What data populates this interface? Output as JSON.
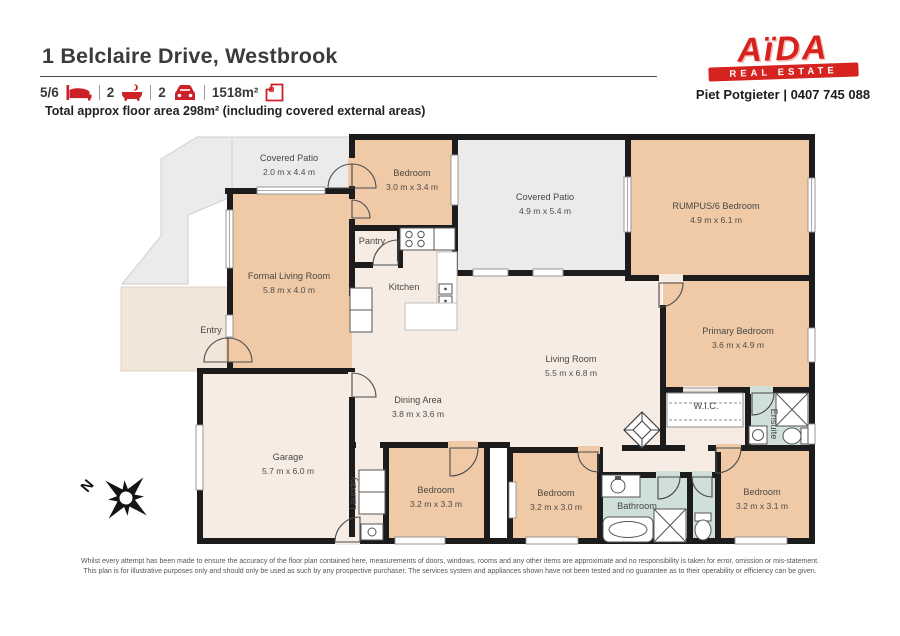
{
  "header": {
    "title": "1 Belclaire Drive, Westbrook",
    "stats": [
      {
        "value": "5/6",
        "icon": "bed-icon"
      },
      {
        "value": "2",
        "icon": "bath-icon"
      },
      {
        "value": "2",
        "icon": "car-icon"
      },
      {
        "value": "1518m²",
        "icon": "land-area-icon"
      }
    ],
    "floor_area_note": "Total approx floor area 298m² (including covered external areas)"
  },
  "agency": {
    "logo_word": "AïDA",
    "logo_banner": "REAL ESTATE",
    "contact": "Piet Potgieter | 0407 745 088"
  },
  "floorplan": {
    "compass_label": "N",
    "rooms": [
      {
        "name": "Covered Patio",
        "dims": "2.0 m x 4.4 m"
      },
      {
        "name": "Bedroom",
        "dims": "3.0 m x 3.4 m"
      },
      {
        "name": "Covered Patio",
        "dims": "4.9 m x 5.4 m"
      },
      {
        "name": "RUMPUS/6 Bedroom",
        "dims": "4.9 m x 6.1 m"
      },
      {
        "name": "Formal Living Room",
        "dims": "5.8 m x 4.0 m"
      },
      {
        "name": "Pantry",
        "dims": ""
      },
      {
        "name": "Kitchen",
        "dims": ""
      },
      {
        "name": "Entry",
        "dims": ""
      },
      {
        "name": "Living Room",
        "dims": "5.5 m x 6.8 m"
      },
      {
        "name": "Dining Area",
        "dims": "3.8 m x 3.6 m"
      },
      {
        "name": "Primary Bedroom",
        "dims": "3.6 m x 4.9 m"
      },
      {
        "name": "W.I.C.",
        "dims": ""
      },
      {
        "name": "Ensuite",
        "dims": ""
      },
      {
        "name": "Garage",
        "dims": "5.7 m x 6.0 m"
      },
      {
        "name": "Laundry",
        "dims": ""
      },
      {
        "name": "Bedroom",
        "dims": "3.2 m x 3.3 m"
      },
      {
        "name": "Bedroom",
        "dims": "3.2 m x 3.0 m"
      },
      {
        "name": "Bathroom",
        "dims": ""
      },
      {
        "name": "Bedroom",
        "dims": "3.2 m x 3.1 m"
      }
    ]
  },
  "footer": {
    "disclaimer_line1": "Whilst every attempt has been made to ensure the accuracy of the floor plan contained here, measurements of doors, windows, rooms and any other items are approximate and no responsibility is taken for error, omission or mis-statement.",
    "disclaimer_line2": "This plan is for illustrative purposes only and should only be used as such by any prospective purchaser. The services system and appliances shown have not been tested and no guarantee as to their operability or efficiency can be given."
  },
  "colors": {
    "accent_red": "#d6231f",
    "wall_black": "#1c1c1c",
    "room_tan": "#f0caa6",
    "room_cream": "#f7ece3",
    "patio_gray": "#ebebeb",
    "wet_area_blue": "#cfdfda",
    "porch_beige": "#f2e5da"
  }
}
